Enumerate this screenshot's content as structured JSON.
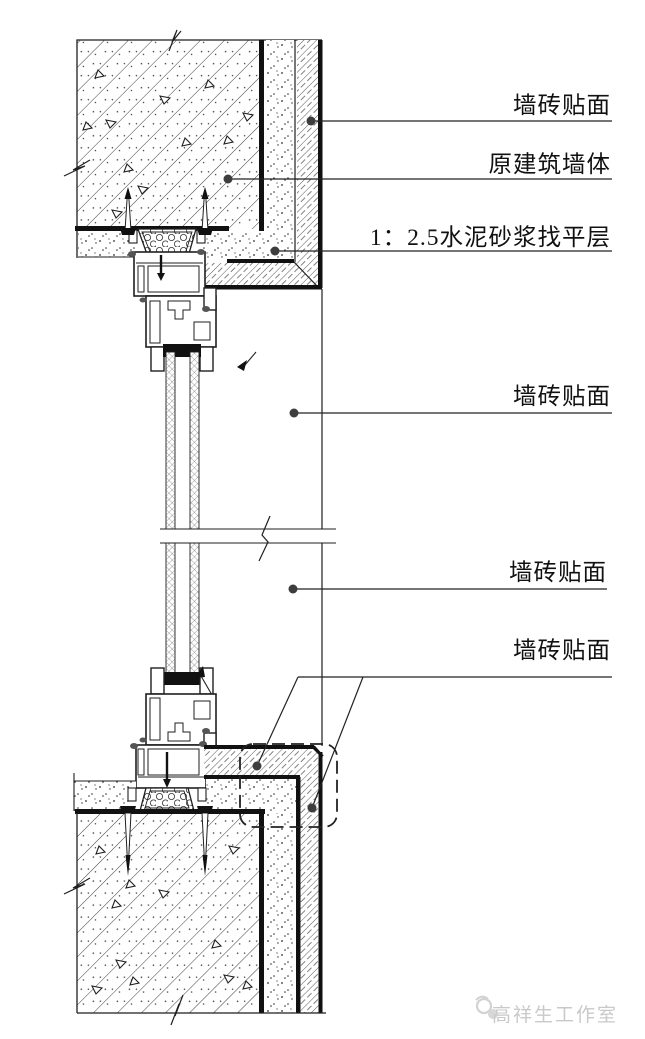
{
  "annotations": {
    "labels": [
      {
        "text": "墙砖贴面"
      },
      {
        "text": "原建筑墙体"
      },
      {
        "text": "1：2.5水泥砂浆找平层"
      },
      {
        "text": "墙砖贴面"
      },
      {
        "text": "墙砖贴面"
      },
      {
        "text": "墙砖贴面"
      }
    ],
    "watermark": "高祥生工作室",
    "colors": {
      "line": "#1f1f1f",
      "thick_line": "#111111",
      "leader_dot": "#3d3d3d",
      "watermark": "#c9c9c9",
      "background": "#ffffff"
    }
  }
}
